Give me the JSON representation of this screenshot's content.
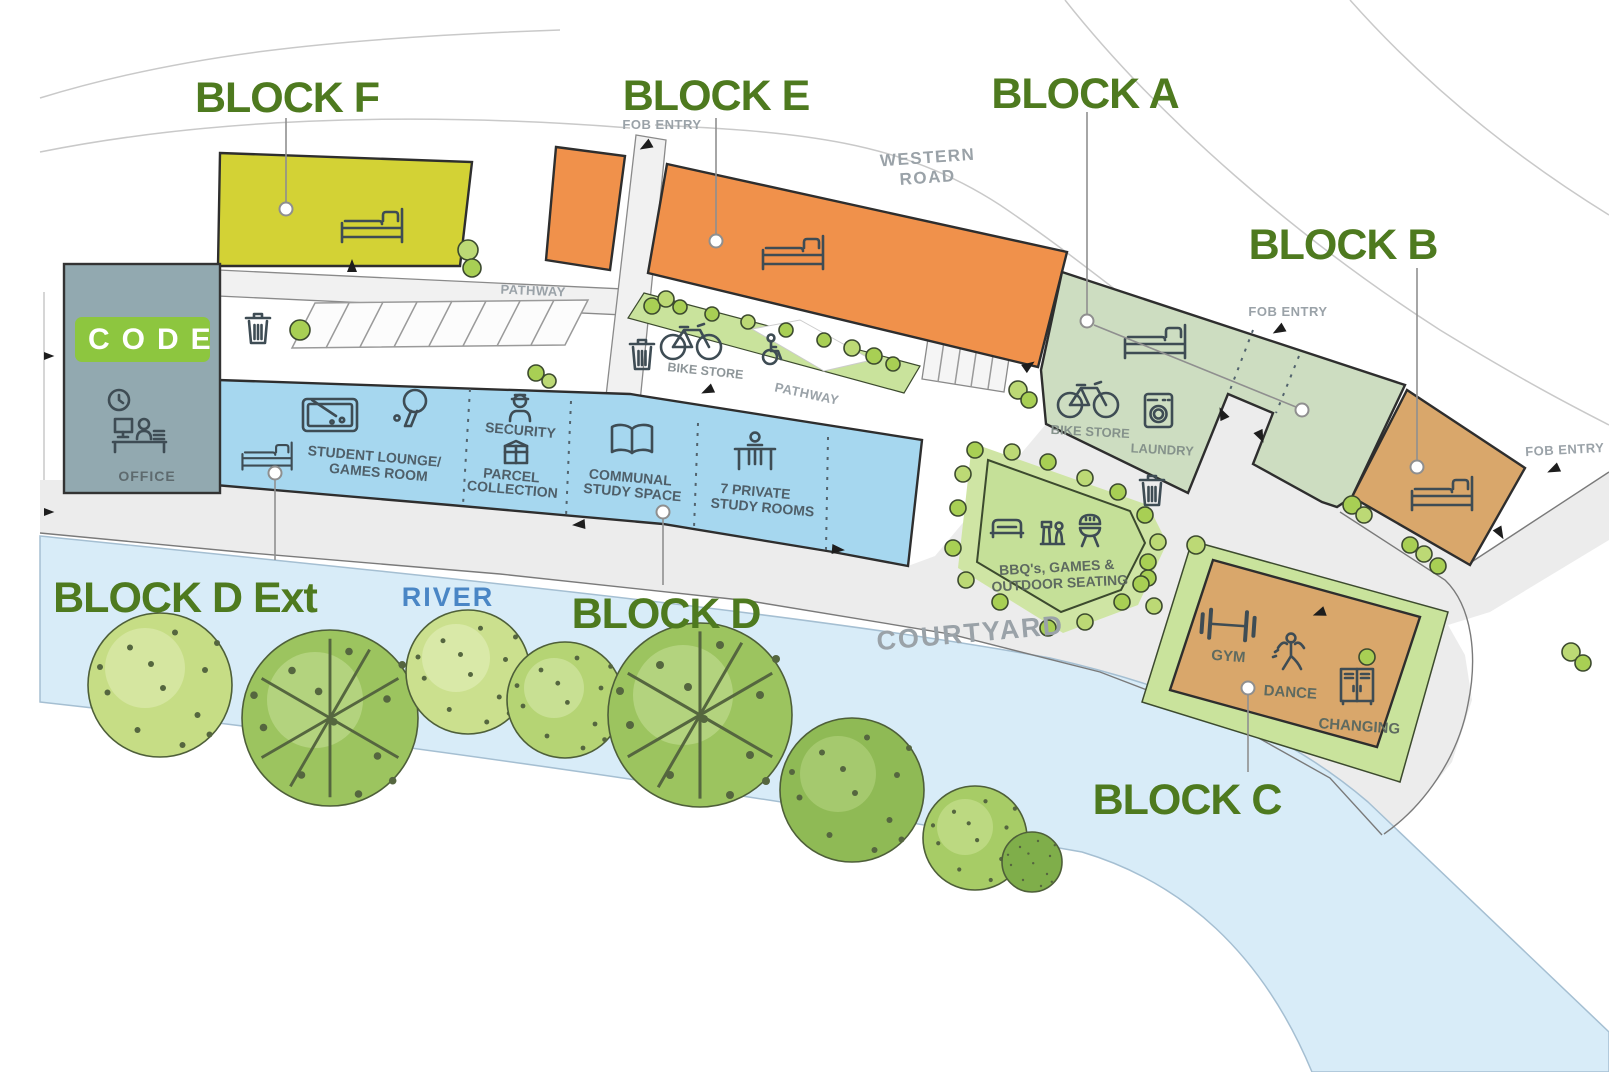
{
  "blocks": {
    "f": "BLOCK F",
    "e": "BLOCK E",
    "a": "BLOCK A",
    "b": "BLOCK B",
    "d_ext": "BLOCK D Ext",
    "d": "BLOCK D",
    "c": "BLOCK C"
  },
  "roads": {
    "western_road_1": "WESTERN",
    "western_road_2": "ROAD",
    "pathway": "PATHWAY",
    "courtyard": "COURTYARD",
    "river": "RIVER",
    "fob_entry": "FOB ENTRY"
  },
  "office": {
    "logo": "CODE",
    "label": "OFFICE"
  },
  "facilities": {
    "bike_store": "BIKE STORE",
    "laundry": "LAUNDRY",
    "lounge_1": "STUDENT LOUNGE/",
    "lounge_2": "GAMES ROOM",
    "security": "SECURITY",
    "parcel_1": "PARCEL",
    "parcel_2": "COLLECTION",
    "communal_1": "COMMUNAL",
    "communal_2": "STUDY SPACE",
    "private_1": "7 PRIVATE",
    "private_2": "STUDY ROOMS",
    "bbq_1": "BBQ's, GAMES &",
    "bbq_2": "OUTDOOR SEATING",
    "gym": "GYM",
    "dance": "DANCE",
    "changing": "CHANGING"
  },
  "colors": {
    "block_f": "#d3d235",
    "block_e": "#f0914b",
    "block_a": "#cdddc1",
    "block_b": "#d9a76b",
    "block_c": "#d9a76b",
    "block_d": "#a6d7ef",
    "office": "#92a9b0",
    "code_green": "#8dc63f",
    "label_green": "#4e7a1f",
    "river_fill": "#d8ecf8",
    "river_text": "#4a86c5",
    "road": "#ececec",
    "grass": "#c9e39c"
  }
}
